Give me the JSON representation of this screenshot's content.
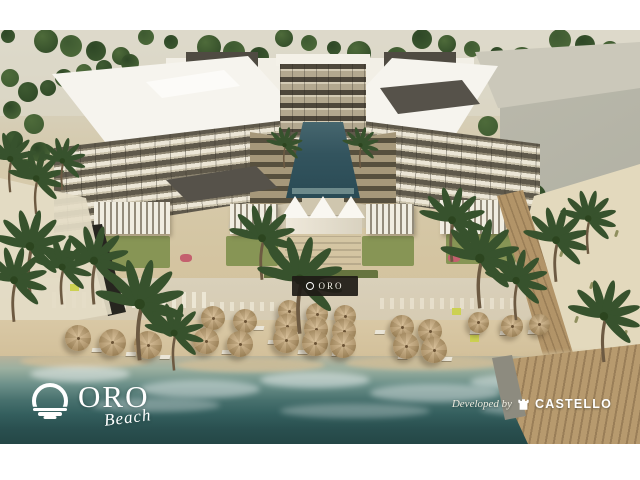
{
  "branding": {
    "name": "ORO",
    "tagline": "Beach",
    "sign_label": "ORO"
  },
  "credit": {
    "prefix": "Developed by",
    "developer": "CASTELLO"
  },
  "palette": {
    "building_white": "#f5f3ec",
    "sand": "#d5c4a1",
    "pool_water": "#2f505c",
    "sea_deep": "#274a4b",
    "sea_mid": "#4e7a77",
    "palm_green": "#37522d",
    "umbrella_straw": "#c4a170",
    "boardwalk_wood": "#b3966a",
    "logo_text": "#ffffff"
  }
}
